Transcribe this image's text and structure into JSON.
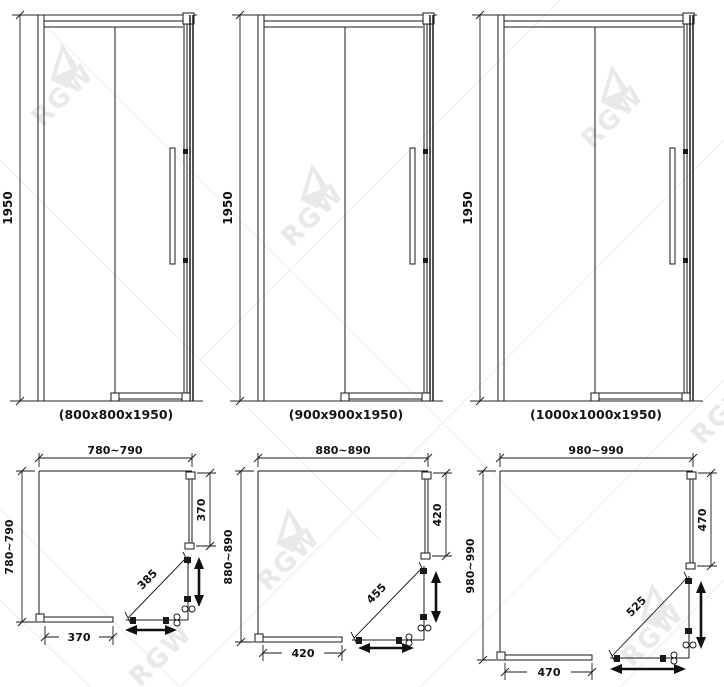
{
  "brand": "RGW",
  "figures": {
    "doors": [
      {
        "height": "1950",
        "caption": "(800x800x1950)"
      },
      {
        "height": "1950",
        "caption": "(900x900x1950)"
      },
      {
        "height": "1950",
        "caption": "(1000x1000x1950)"
      }
    ],
    "plans": [
      {
        "top_width": "780~790",
        "left_depth": "780~790",
        "right_panel": "370",
        "diagonal_door": "385",
        "bottom_panel": "370"
      },
      {
        "top_width": "880~890",
        "left_depth": "880~890",
        "right_panel": "420",
        "diagonal_door": "455",
        "bottom_panel": "420"
      },
      {
        "top_width": "980~990",
        "left_depth": "980~990",
        "right_panel": "470",
        "diagonal_door": "525",
        "bottom_panel": "470"
      }
    ]
  }
}
